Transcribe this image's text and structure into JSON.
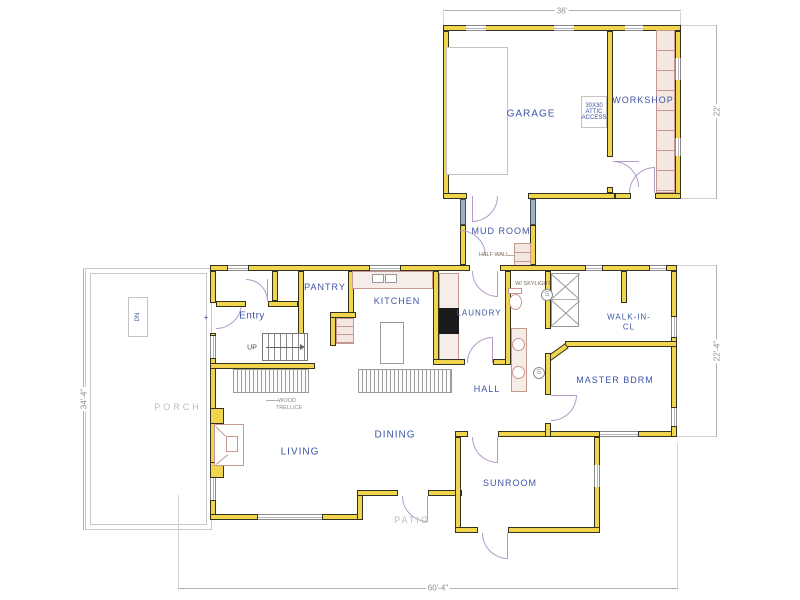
{
  "rooms": {
    "garage": "GARAGE",
    "workshop": "WORKSHOP",
    "mudroom": "MUD ROOM",
    "entry": "Entry",
    "pantry": "PANTRY",
    "kitchen": "KITCHEN",
    "laundry": "LAUNDRY",
    "walkin_line1": "WALK-IN-",
    "walkin_line2": "CL",
    "master": "MASTER BDRM",
    "hall": "HALL",
    "dining": "DINING",
    "living": "LIVING",
    "sunroom": "SUNROOM",
    "porch": "PORCH",
    "patio": "PATIO"
  },
  "annotations": {
    "up": "UP",
    "dn": "DN",
    "half_wall": "HALF WALL",
    "wood_trellis_line1": "WOOD",
    "wood_trellis_line2": "TRELLICE",
    "attic_line1": "30X30",
    "attic_line2": "ATTIC",
    "attic_line3": "ACCESS",
    "shower_note": "W/ SKYLIGHT",
    "smoke_detector": "S",
    "plus_marker": "+"
  },
  "dimensions": {
    "garage_width": "36'",
    "garage_depth": "22'",
    "master_wing_depth": "22'-4\"",
    "house_depth": "34'-4\"",
    "house_width": "60'-4\""
  },
  "colors": {
    "wall_yellow": "#f2d54e",
    "label_blue": "#3d55a5",
    "dimension_gray": "#8f8f8f",
    "door_purple": "#b49ac8",
    "cabinet_pink": "#c7988f",
    "glazing_gray": "#9fb0bf"
  }
}
